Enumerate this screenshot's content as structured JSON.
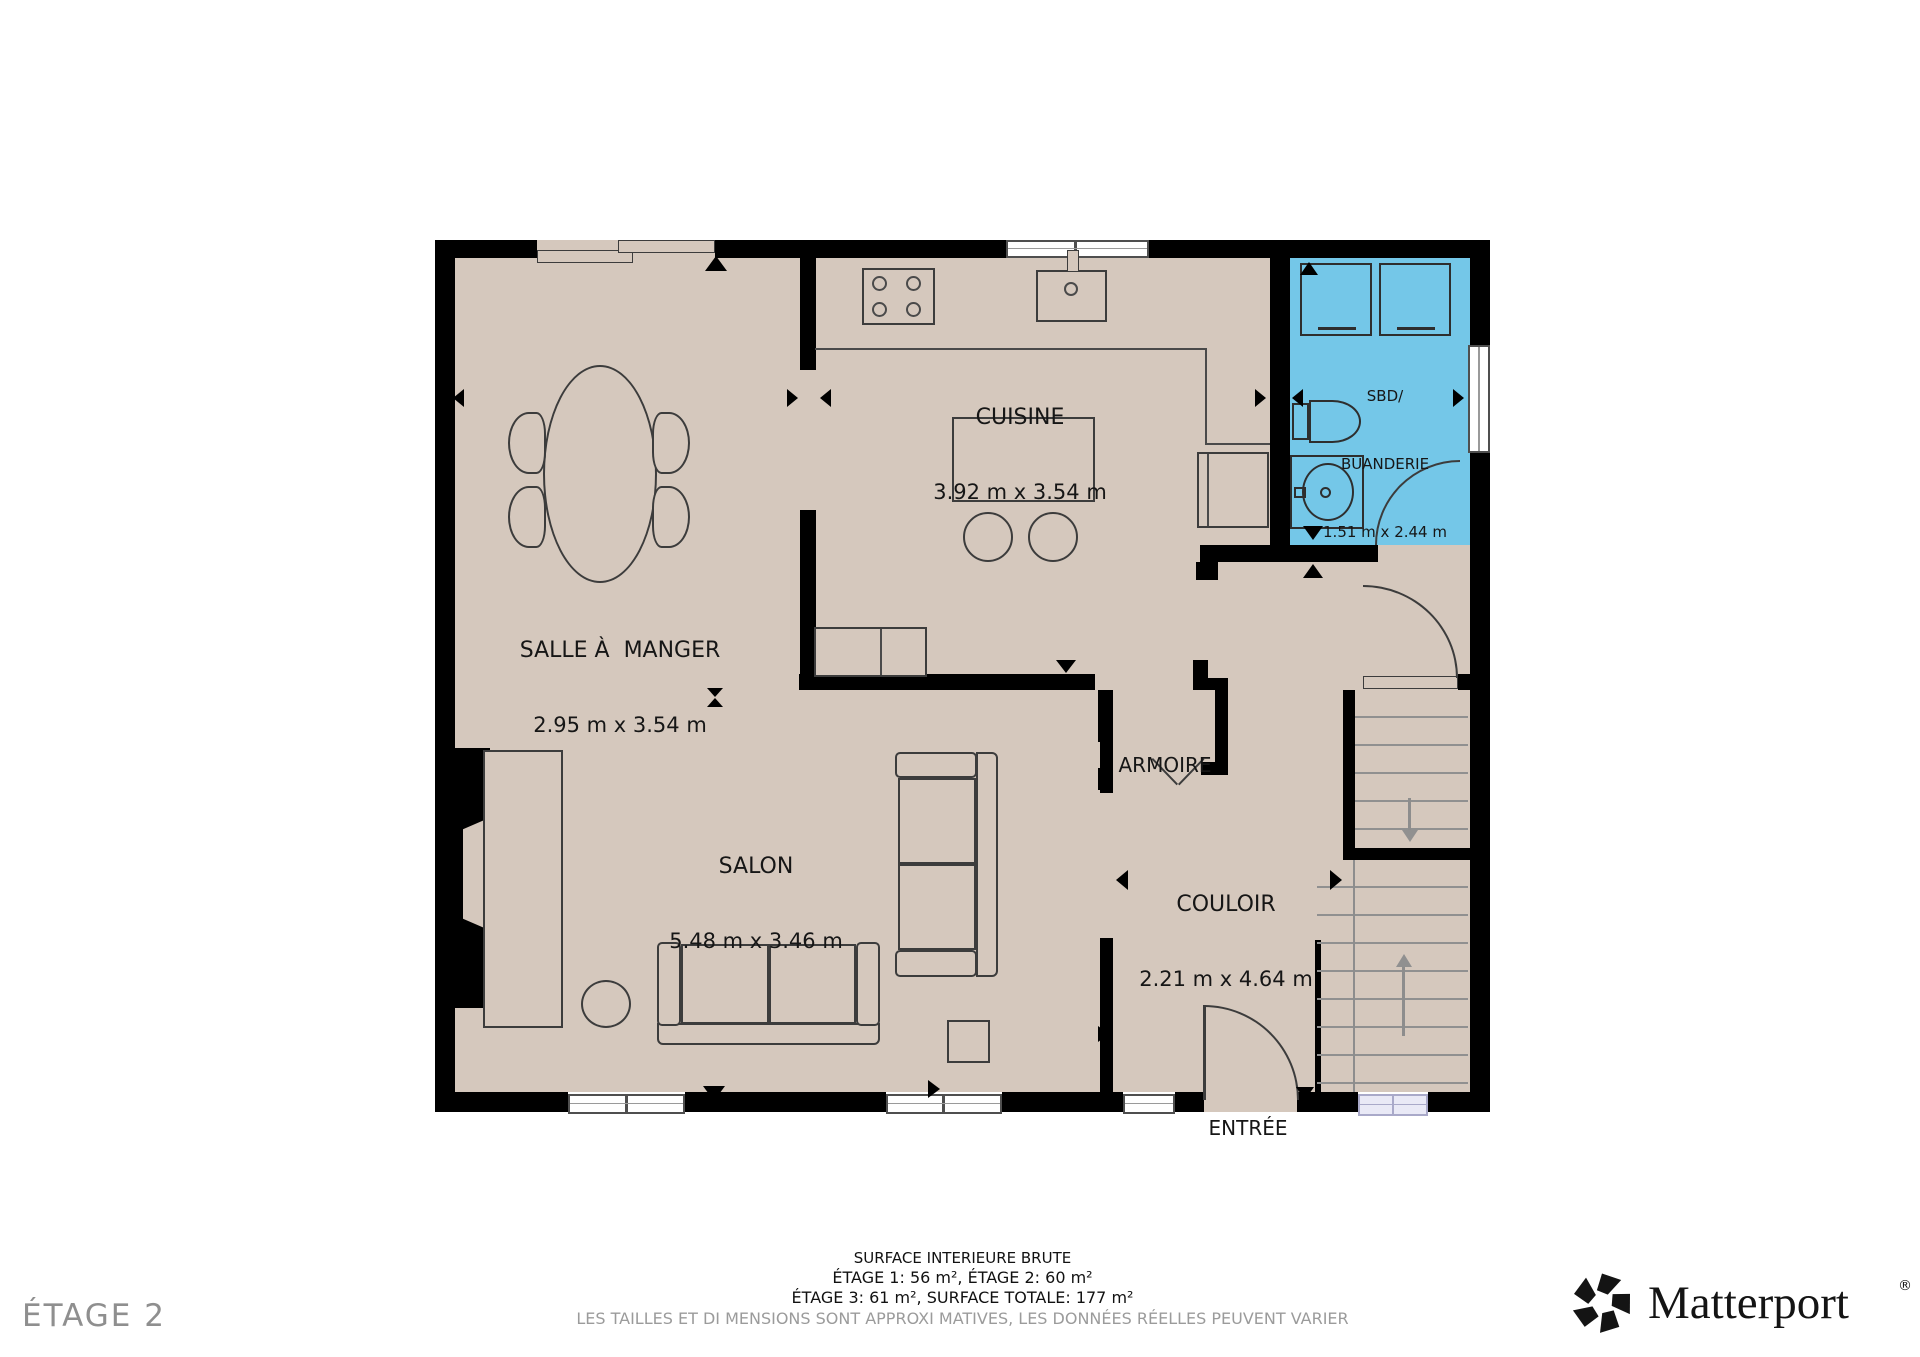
{
  "plan": {
    "floor_label": "ÉTAGE 2",
    "rooms": {
      "salle_a_manger": {
        "name": "SALLE À  MANGER",
        "dims": "2.95 m x 3.54 m"
      },
      "cuisine": {
        "name": "CUISINE",
        "dims": "3.92 m x 3.54 m"
      },
      "sbd_buanderie": {
        "name_line1": "SBD/",
        "name_line2": "BUANDERIE",
        "dims": "1.51 m x 2.44 m"
      },
      "armoire": {
        "name": "ARMOIRE"
      },
      "salon": {
        "name": "SALON",
        "dims": "5.48 m x 3.46 m"
      },
      "couloir": {
        "name": "COULOIR",
        "dims": "2.21 m x 4.64 m"
      },
      "entree": {
        "name": "ENTRÉE"
      }
    },
    "colors": {
      "floor": "#d5c8bd",
      "walls": "#000000",
      "bathroom_highlight": "#74c7e8",
      "window_lavender": "#e9e9f6"
    }
  },
  "footer": {
    "line1": "SURFACE INTERIEURE BRUTE",
    "line2": "ÉTAGE 1: 56 m², ÉTAGE 2: 60 m²",
    "line3": "ÉTAGE 3: 61 m², SURFACE TOTALE: 177 m²",
    "disclaimer": "LES TAILLES ET DI MENSIONS SONT APPROXI MATIVES, LES DONNÉES RÉELLES PEUVENT VARIER"
  },
  "branding": {
    "logo_text": "Matterport",
    "registered": "®"
  }
}
